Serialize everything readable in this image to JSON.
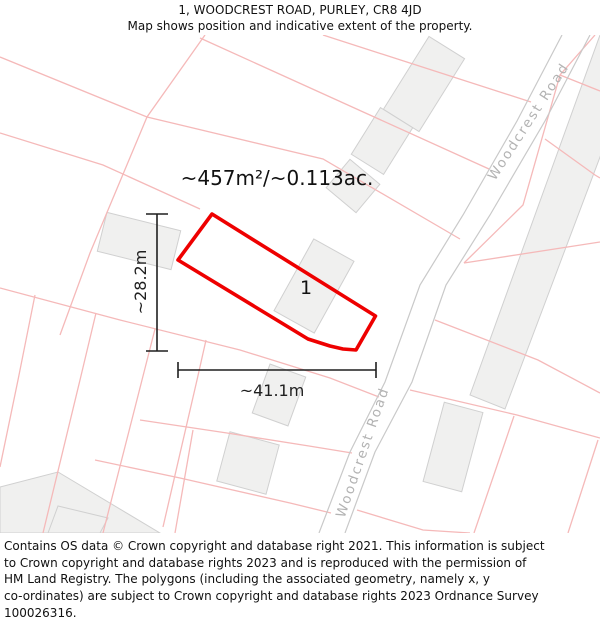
{
  "header": {
    "title": "1, WOODCREST ROAD, PURLEY, CR8 4JD",
    "subtitle": "Map shows position and indicative extent of the property."
  },
  "map": {
    "area_label": "~457m²/~0.113ac.",
    "plot_number": "1",
    "width_label": "~41.1m",
    "height_label": "~28.2m",
    "road_name": "Woodcrest Road",
    "colors": {
      "plot_outline": "#ee0000",
      "parcel_line": "#f5b9b9",
      "road_edge": "#c9c9c9",
      "building_fill": "#f0f0ef",
      "building_stroke": "#d0d0d0",
      "road_label": "#b3b3b3",
      "dimension": "#1f1f1f",
      "text": "#111111"
    }
  },
  "footer": {
    "lines": [
      "Contains OS data © Crown copyright and database right 2021. This information is subject",
      "to Crown copyright and database rights 2023 and is reproduced with the permission of",
      "HM Land Registry. The polygons (including the associated geometry, namely x, y",
      "co-ordinates) are subject to Crown copyright and database rights 2023 Ordnance Survey",
      "100026316."
    ]
  }
}
